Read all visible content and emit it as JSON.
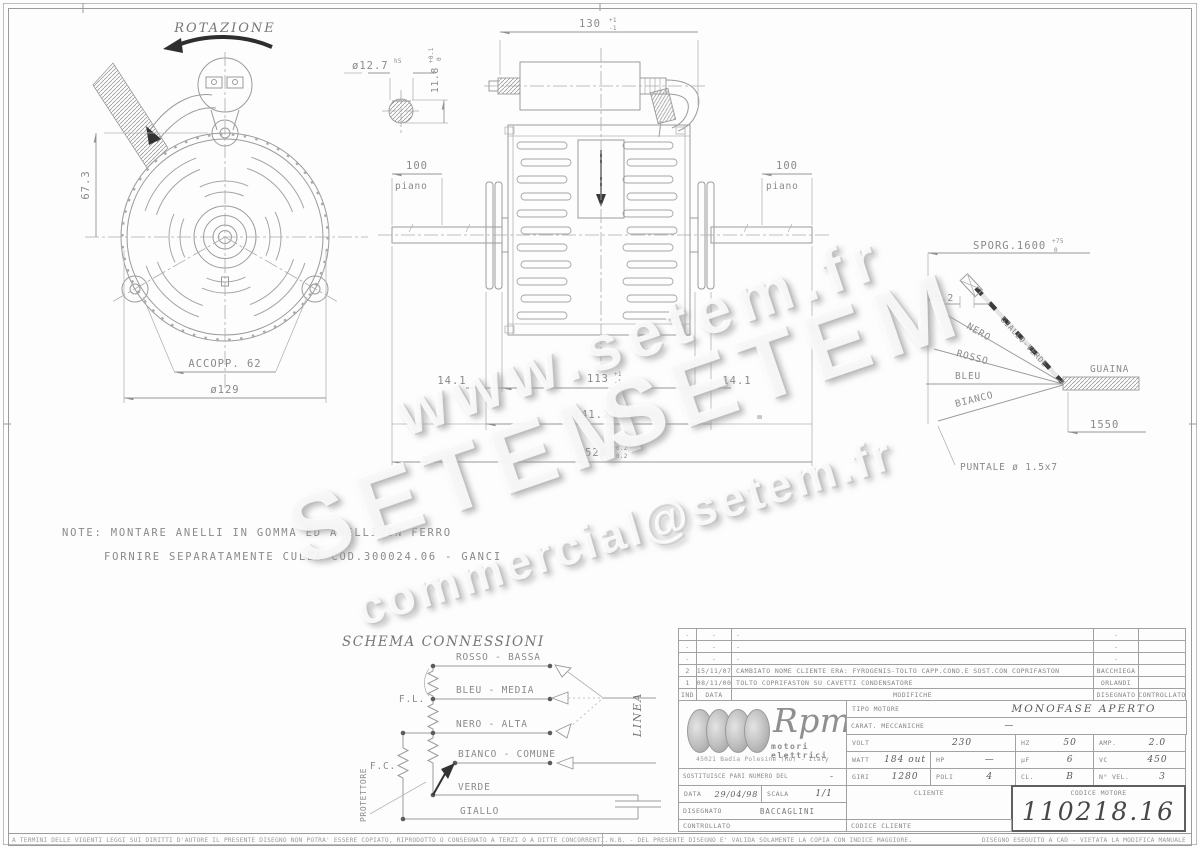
{
  "wm": {
    "url": "www.setem.fr",
    "s1": "SETEM",
    "s2": "SETEM",
    "email": "commercial@setem.fr"
  },
  "front": {
    "rotazione": "ROTAZIONE",
    "h": "67.3",
    "accopp": "ACCOPP. 62",
    "dia": "ø129"
  },
  "shaft": {
    "dia": "ø12.7",
    "fit": "h5",
    "flat": "11.8",
    "tp": "+0.1",
    "tm": "0"
  },
  "side": {
    "d130": "130",
    "d130p": "+1",
    "d130m": "-1",
    "l100": "100",
    "lpiano": "piano",
    "r100": "100",
    "rpiano": "piano",
    "l141": "14.1",
    "d113": "113",
    "d113p": "+1",
    "d113m": "-1",
    "r141": "14.1",
    "eq": "=",
    "d1412": "141.2",
    "d1412p": "+1",
    "d1412m": "-1",
    "d520": "520",
    "d520p": "+0.2",
    "d520m": "-0.2"
  },
  "cable": {
    "sporg": "SPORG.1600",
    "sp": "+75",
    "sm": "0",
    "dia": "ø5.2",
    "gv": "GIALLO-VERDE",
    "nero": "NERO",
    "rosso": "ROSSO",
    "bleu": "BLEU",
    "bianco": "BIANCO",
    "guaina": "GUAINA",
    "len": "1550",
    "puntale": "PUNTALE ø 1.5x7"
  },
  "note": {
    "l1": "NOTE: MONTARE ANELLI IN GOMMA ED ANELLI IN FERRO",
    "l2": "FORNIRE SEPARATAMENTE CULLA COD.300024.06 - GANCI"
  },
  "schema": {
    "title": "SCHEMA CONNESSIONI",
    "rosso": "ROSSO - BASSA",
    "bleu": "BLEU - MEDIA",
    "nero": "NERO - ALTA",
    "bianco": "BIANCO - COMUNE",
    "verde": "VERDE",
    "giallo": "GIALLO",
    "fl": "F.L.",
    "fc": "F.C.",
    "protettore": "PROTETTORE",
    "linea": "LINEA"
  },
  "tb": {
    "rev": [
      {
        "ind": "-",
        "data": "-",
        "desc": "-",
        "sign": "-",
        "ctrl": ""
      },
      {
        "ind": "-",
        "data": "-",
        "desc": "-",
        "sign": "-",
        "ctrl": ""
      },
      {
        "ind": "-",
        "data": "-",
        "desc": "-",
        "sign": "-",
        "ctrl": ""
      },
      {
        "ind": "2",
        "data": "15/11/07",
        "desc": "CAMBIATO NOME CLIENTE ERA: FYROGENIS-TOLTO CAPP.COND.E SOST.CON COPRIFASTON",
        "sign": "BACCHIEGA",
        "ctrl": ""
      },
      {
        "ind": "1",
        "data": "08/11/00",
        "desc": "TOLTO COPRIFASTON SU CAVETTI CONDENSATORE",
        "sign": "ORLANDI",
        "ctrl": ""
      }
    ],
    "hdr": {
      "ind": "IND",
      "data": "DATA",
      "mod": "MODIFICHE",
      "dis": "DISEGNATO",
      "ctr": "CONTROLLATO"
    },
    "logo": {
      "name": "Rpm",
      "sub": "motori elettrici",
      "addr": "45021 Badia Polesine (Ro) - Italy"
    },
    "f": {
      "tipo_l": "TIPO MOTORE",
      "tipo": "MONOFASE APERTO",
      "carat_l": "CARAT. MECCANICHE",
      "carat": "—",
      "volt_l": "VOLT",
      "volt": "230",
      "hz_l": "HZ",
      "hz": "50",
      "amp_l": "AMP.",
      "amp": "2.0",
      "watt_l": "WATT",
      "watt": "184 out",
      "hp_l": "HP",
      "hp": "—",
      "uf_l": "µF",
      "uf": "6",
      "vc_l": "VC",
      "vc": "450",
      "giri_l": "GIRI",
      "giri": "1280",
      "poli_l": "POLI",
      "poli": "4",
      "cl_l": "CL.",
      "cl": "B",
      "nvel_l": "N° VEL.",
      "nvel": "3",
      "sost_l": "SOSTITUISCE PARI NUMERO DEL",
      "sost": "-",
      "data_l": "DATA",
      "data": "29/04/98",
      "scala_l": "SCALA",
      "scala": "1/1",
      "dis_l": "DISEGNATO",
      "dis": "BACCAGLINI",
      "ctr_l": "CONTROLLATO",
      "cliente_l": "CLIENTE",
      "codcli_l": "CODICE CLIENTE",
      "codmot_l": "CODICE MOTORE",
      "codmot": "110218.16"
    }
  },
  "footer": {
    "left": "A TERMINI DELLE VIGENTI LEGGI SUI DIRITTI D'AUTORE IL PRESENTE DISEGNO NON POTRA' ESSERE COPIATO, RIPRODOTTO O CONSEGNATO A TERZI O A DITTE CONCORRENTI.",
    "nb": "N.B. - DEL PRESENTE DISEGNO E' VALIDA SOLAMENTE LA COPIA CON INDICE MAGGIORE.",
    "right": "DISEGNO ESEGUITO A CAD - VIETATA LA MODIFICA MANUALE"
  }
}
